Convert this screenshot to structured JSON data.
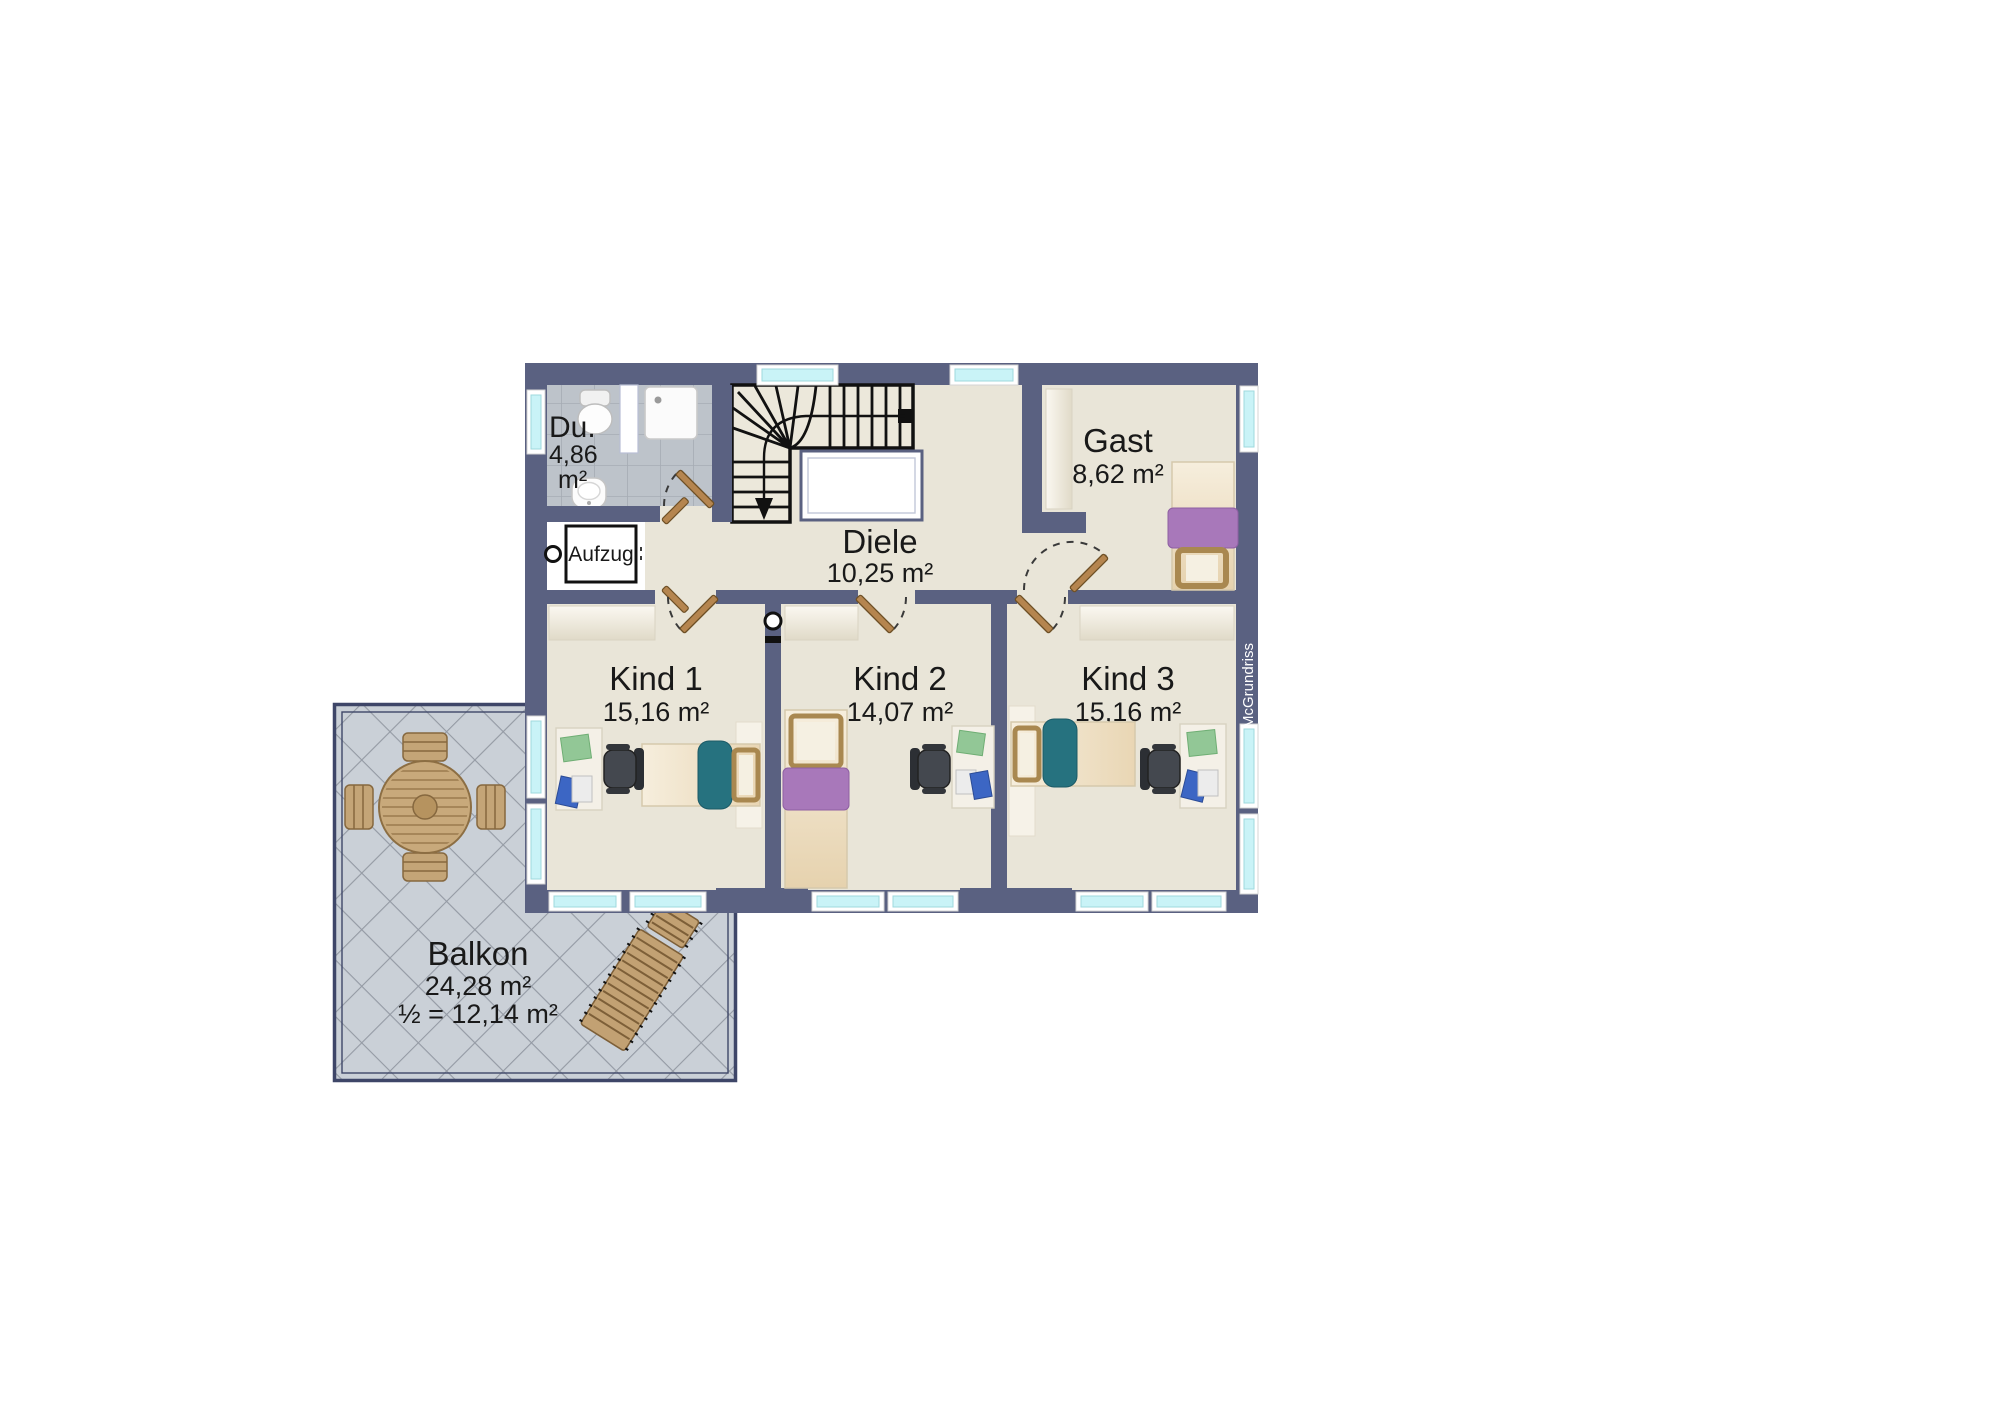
{
  "watermark": "McGrundriss",
  "rooms": {
    "du": {
      "name": "Du.",
      "area_value": "4,86",
      "area_unit": "m²"
    },
    "aufzug": {
      "name": "Aufzug"
    },
    "diele": {
      "name": "Diele",
      "area": "10,25 m²"
    },
    "gast": {
      "name": "Gast",
      "area": "8,62 m²"
    },
    "kind1": {
      "name": "Kind 1",
      "area": "15,16 m²"
    },
    "kind2": {
      "name": "Kind 2",
      "area": "14,07 m²"
    },
    "kind3": {
      "name": "Kind 3",
      "area": "15,16 m²"
    },
    "balkon": {
      "name": "Balkon",
      "area": "24,28 m²",
      "area_half": "½ = 12,14 m²"
    }
  },
  "colors": {
    "wall": "#5a6181",
    "floor": "#e9e5d8",
    "bath_tile": "#bdc3ca",
    "balcony_tile": "#cad0d7",
    "window_glass": "#c9f3f7",
    "wood": "#c2a173",
    "teal": "#26727f",
    "purple": "#a878ba",
    "green": "#92c796"
  }
}
